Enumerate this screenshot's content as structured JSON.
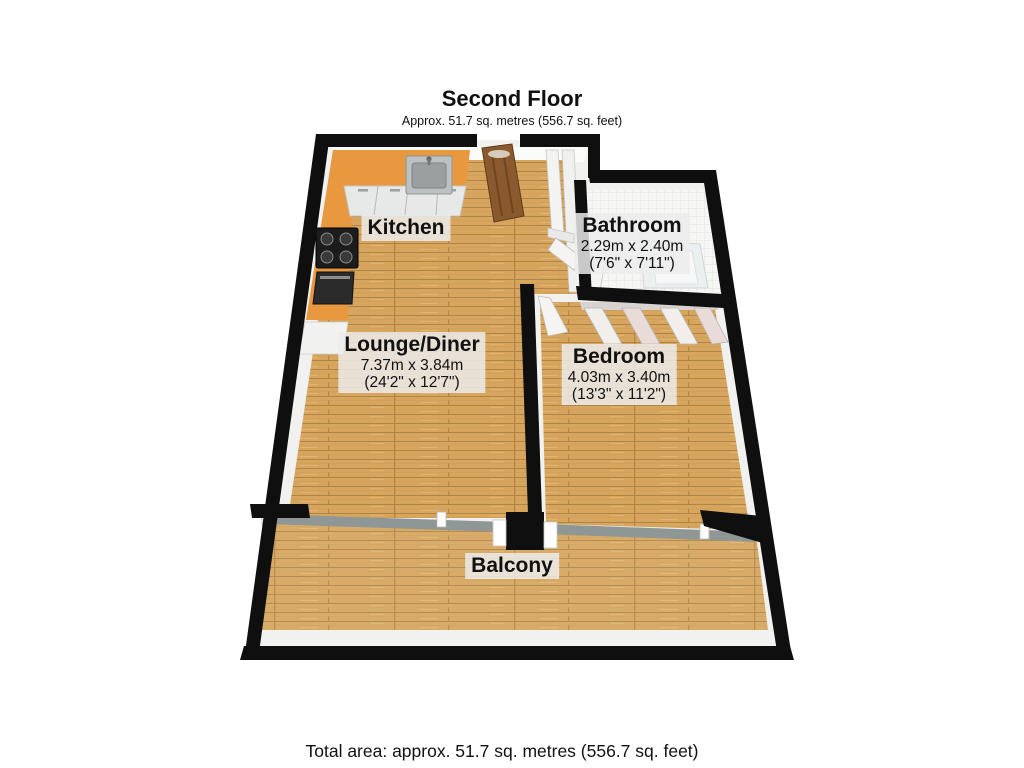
{
  "floor": {
    "title": "Second Floor",
    "subtitle": "Approx. 51.7 sq. metres (556.7 sq. feet)"
  },
  "rooms": {
    "kitchen": {
      "name": "Kitchen"
    },
    "bathroom": {
      "name": "Bathroom",
      "dimensions_m": "2.29m x 2.40m",
      "dimensions_ft": "(7'6\" x 7'11\")"
    },
    "lounge": {
      "name": "Lounge/Diner",
      "dimensions_m": "7.37m x 3.84m",
      "dimensions_ft": "(24'2\" x 12'7\")"
    },
    "bedroom": {
      "name": "Bedroom",
      "dimensions_m": "4.03m x 3.40m",
      "dimensions_ft": "(13'3\" x 11'2\")"
    },
    "balcony": {
      "name": "Balcony"
    }
  },
  "footer": {
    "total_area": "Total area: approx. 51.7 sq. metres (556.7 sq. feet)"
  },
  "colors": {
    "wall": "#0f0f0f",
    "wood": "#d7a55d",
    "wood_line": "#a87f42",
    "counter": "#e8983f",
    "tile": "#f6f6f5",
    "label_bg": "#ececec"
  }
}
